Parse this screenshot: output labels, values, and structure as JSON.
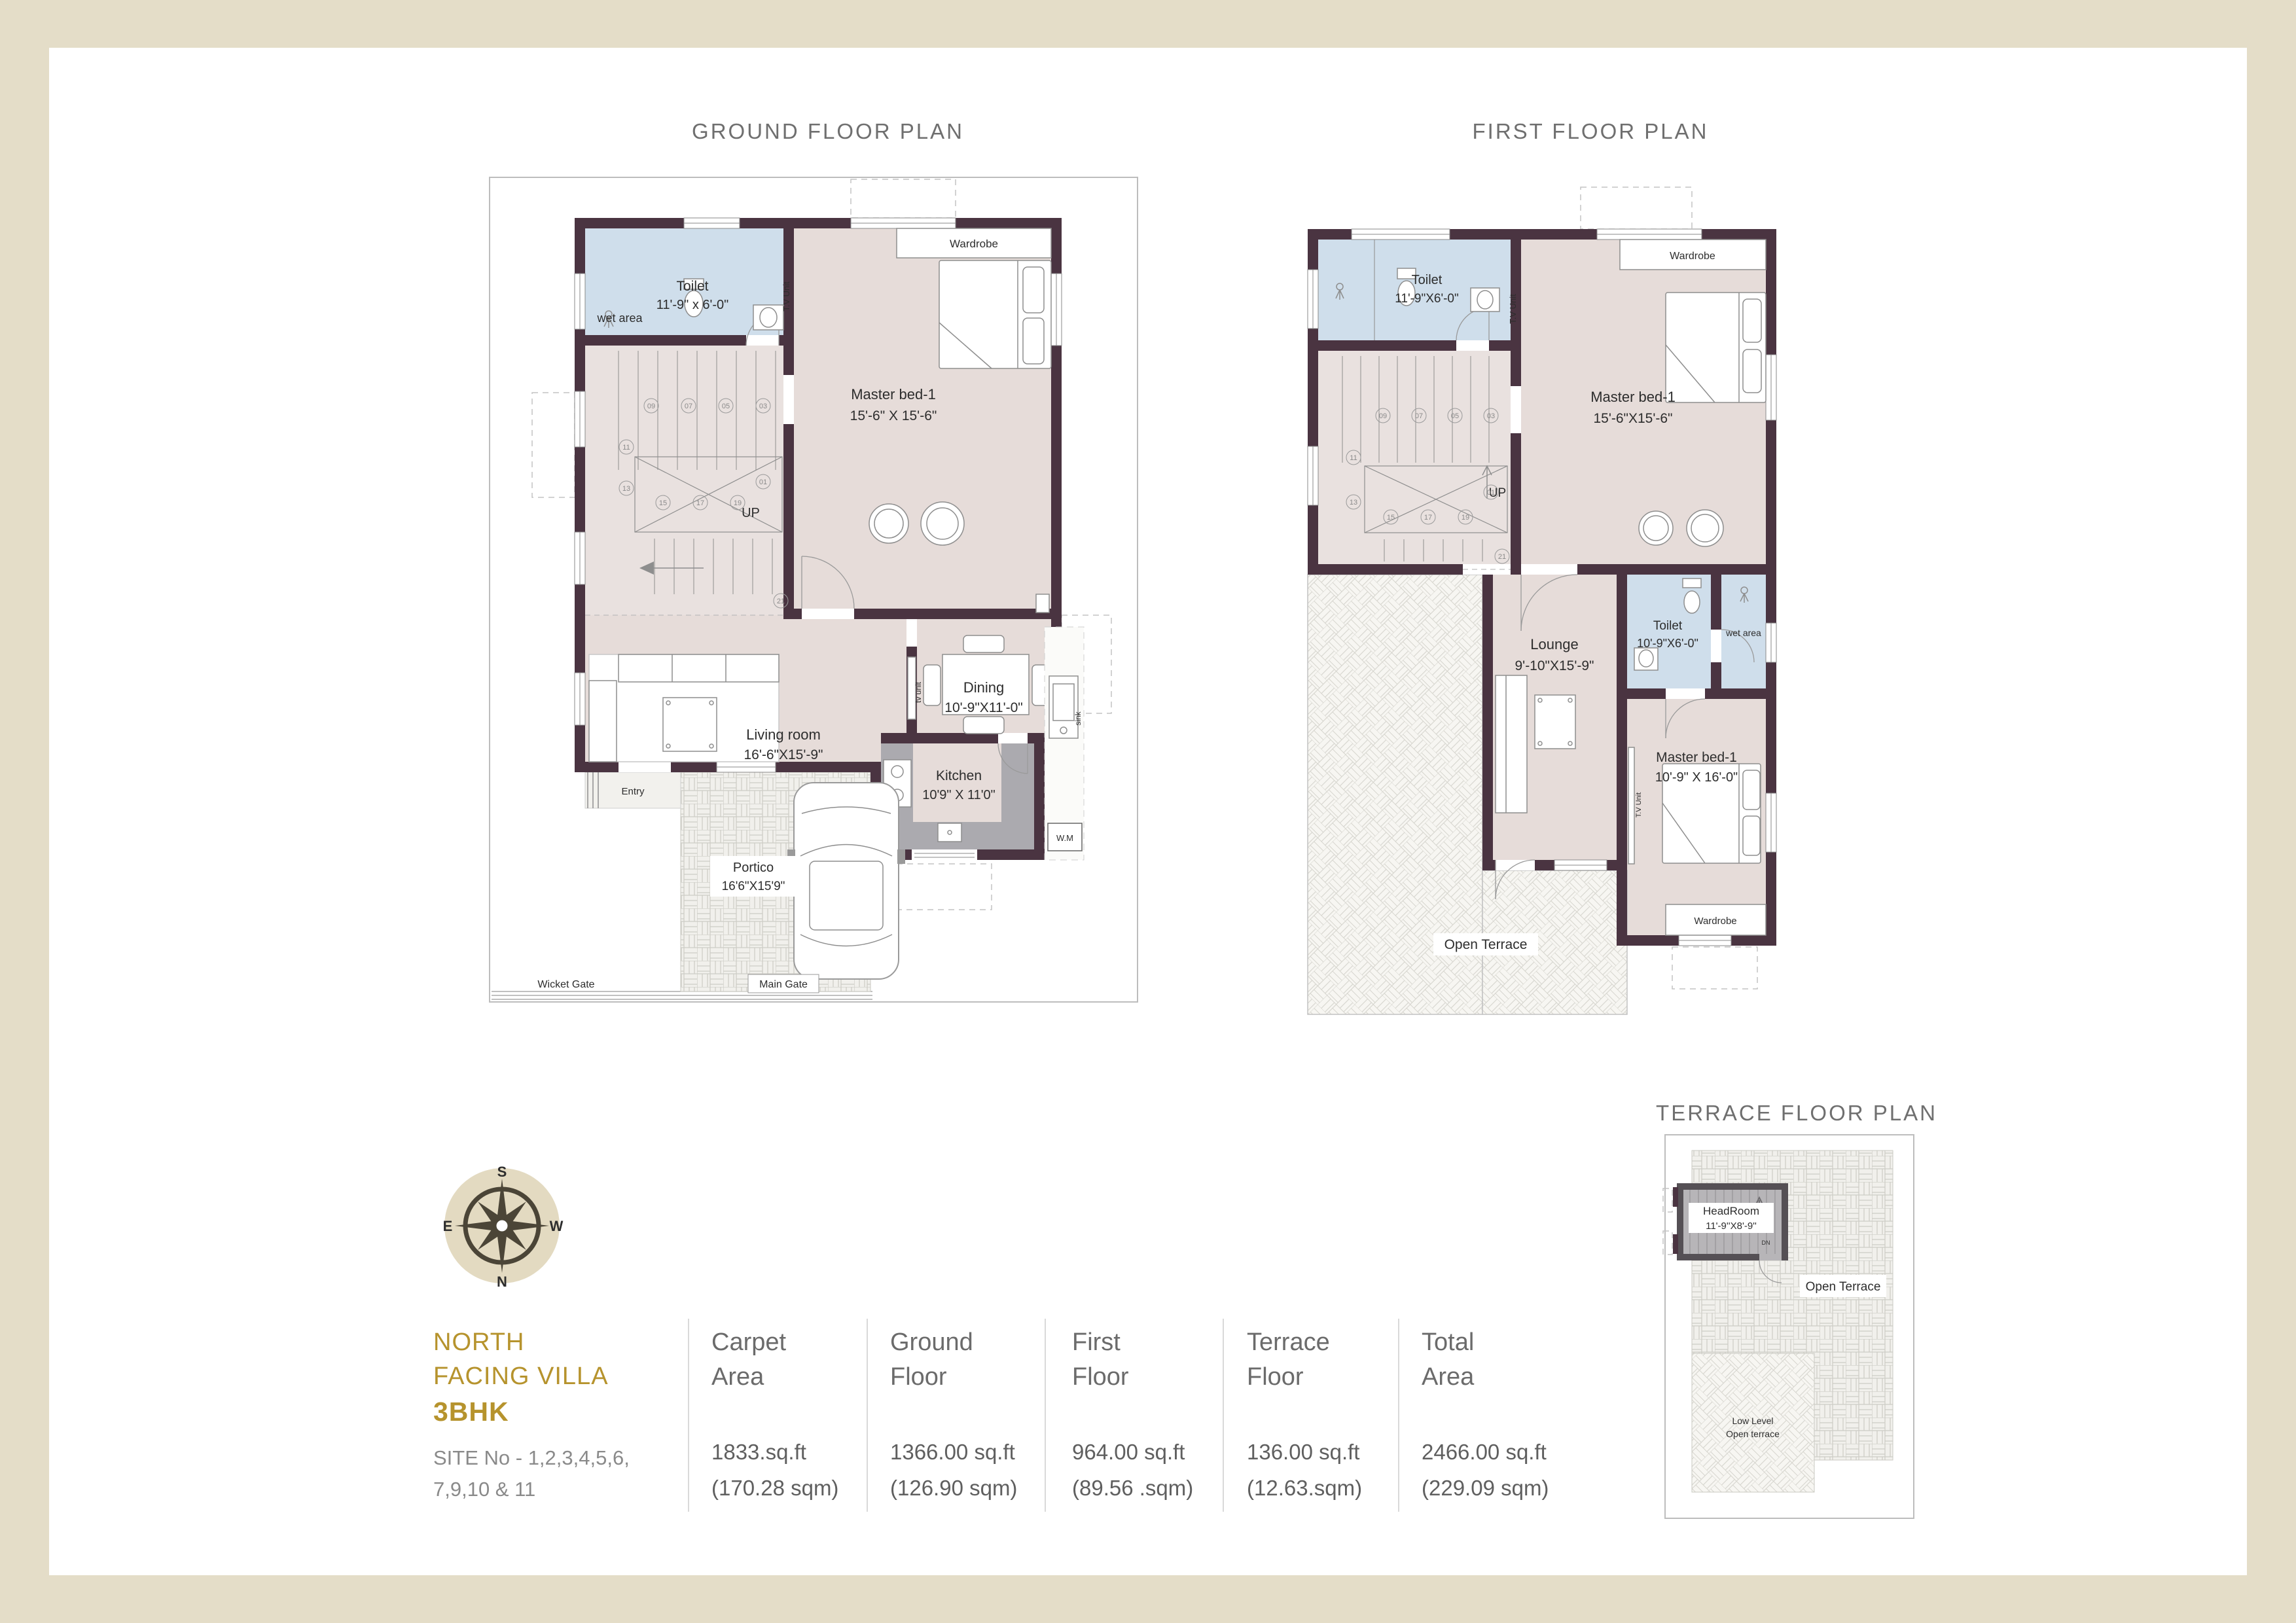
{
  "titles": {
    "ground": "GROUND FLOOR PLAN",
    "first": "FIRST FLOOR PLAN",
    "terrace": "TERRACE FLOOR PLAN"
  },
  "ground_floor": {
    "wet_area": "wet area",
    "toilet": {
      "name": "Toilet",
      "dims": "11'-9\" x 6'-0\""
    },
    "wardrobe": "Wardrobe",
    "master_bed": {
      "name": "Master bed-1",
      "dims": "15'-6\" X 15'-6\""
    },
    "tv_unit": "T.V Unit",
    "up": "UP",
    "living": {
      "name": "Living room",
      "dims": "16'-6\"X15'-9\""
    },
    "dining": {
      "name": "Dining",
      "dims": "10'-9\"X11'-0\""
    },
    "kitchen": {
      "name": "Kitchen",
      "dims": "10'9\" X 11'0\""
    },
    "tv_unit_small": "tv unit",
    "sink": "sink",
    "wm": "W.M",
    "entry": "Entry",
    "portico": {
      "name": "Portico",
      "dims": "16'6\"X15'9\""
    },
    "wicket_gate": "Wicket Gate",
    "main_gate": "Main Gate"
  },
  "first_floor": {
    "toilet1": {
      "name": "Toilet",
      "dims": "11'-9\"X6'-0\""
    },
    "wardrobe1": "Wardrobe",
    "master_bed1": {
      "name": "Master bed-1",
      "dims": "15'-6\"X15'-6\""
    },
    "tv_unit1": "T.V Unit",
    "up": "UP",
    "lounge": {
      "name": "Lounge",
      "dims": "9'-10\"X15'-9\""
    },
    "toilet2": {
      "name": "Toilet",
      "dims": "10'-9\"X6'-0\""
    },
    "wet_area": "wet area",
    "master_bed2": {
      "name": "Master bed-1",
      "dims": "10'-9\" X 16'-0\""
    },
    "tv_unit2": "T.V Unit",
    "wardrobe2": "Wardrobe",
    "open_terrace": "Open Terrace"
  },
  "terrace_floor": {
    "headroom": {
      "name": "HeadRoom",
      "dims": "11'-9''X8'-9''"
    },
    "dn": "DN",
    "open_terrace": "Open Terrace",
    "low_level1": "Low Level",
    "low_level2": "Open terrace"
  },
  "stair_numbers": [
    "09",
    "07",
    "05",
    "03",
    "11",
    "01",
    "13",
    "15",
    "17",
    "19",
    "21"
  ],
  "compass": {
    "n": "N",
    "s": "S",
    "e": "E",
    "w": "W"
  },
  "info": {
    "title_line1": "NORTH",
    "title_line2": "FACING VILLA",
    "title_line3": "3BHK",
    "site_line1": "SITE No - 1,2,3,4,5,6,",
    "site_line2": "7,9,10 & 11",
    "stats": [
      {
        "label1": "Carpet",
        "label2": "Area",
        "value": "1833.sq.ft",
        "metric": "(170.28 sqm)"
      },
      {
        "label1": "Ground",
        "label2": "Floor",
        "value": "1366.00 sq.ft",
        "metric": "(126.90 sqm)"
      },
      {
        "label1": "First",
        "label2": "Floor",
        "value": "964.00 sq.ft",
        "metric": "(89.56 .sqm)"
      },
      {
        "label1": "Terrace",
        "label2": "Floor",
        "value": "136.00 sq.ft",
        "metric": "(12.63.sqm)"
      },
      {
        "label1": "Total",
        "label2": "Area",
        "value": "2466.00 sq.ft",
        "metric": "(229.09 sqm)"
      }
    ]
  },
  "colors": {
    "frame_beige": "#e4ddc8",
    "wall_maroon": "#4a3441",
    "toilet_blue": "#cfdeeb",
    "floor_pink": "#e6dcd9",
    "accent_gold": "#b6932d",
    "heading_gray": "#6f6f6f"
  }
}
